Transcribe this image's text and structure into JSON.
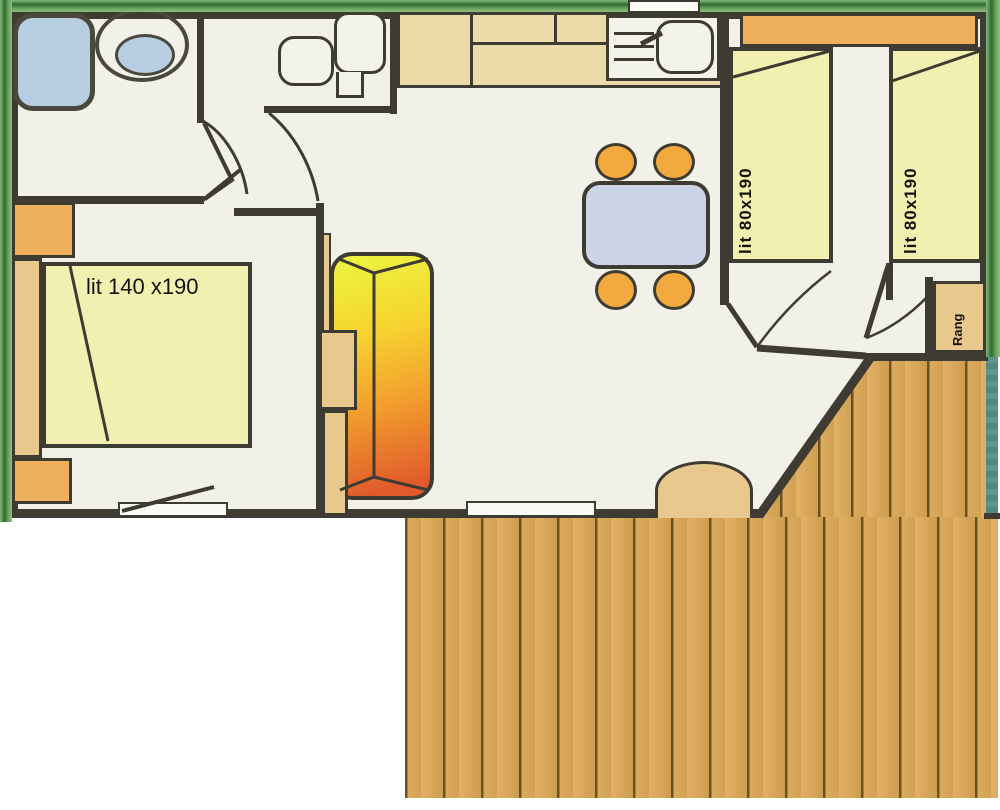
{
  "diagram": {
    "type": "mobile-home floor plan",
    "labels": {
      "master_bed": "lit 140 x190",
      "single_bed_left": "lit 80x190",
      "single_bed_right": "lit 80x190",
      "storage": "Rang"
    },
    "colors": {
      "wall": "#3e3b32",
      "floor": "#f2f1e9",
      "shell_green": "#6da55f",
      "hedge_teal": "#5d978b",
      "bed_yellow": "#f2f0b0",
      "furniture_orange": "#eeb05c",
      "furniture_tan": "#e9c88e",
      "kitchen_counter": "#ecdaa9",
      "fixture_blue": "#b7cde1",
      "dining_table_blue": "#cbd5e7",
      "chair_orange": "#f2a93e",
      "sofa_gradient_start": "#eef13f",
      "sofa_gradient_end": "#e05a2b",
      "deck_wood": "#d9a95c"
    }
  }
}
